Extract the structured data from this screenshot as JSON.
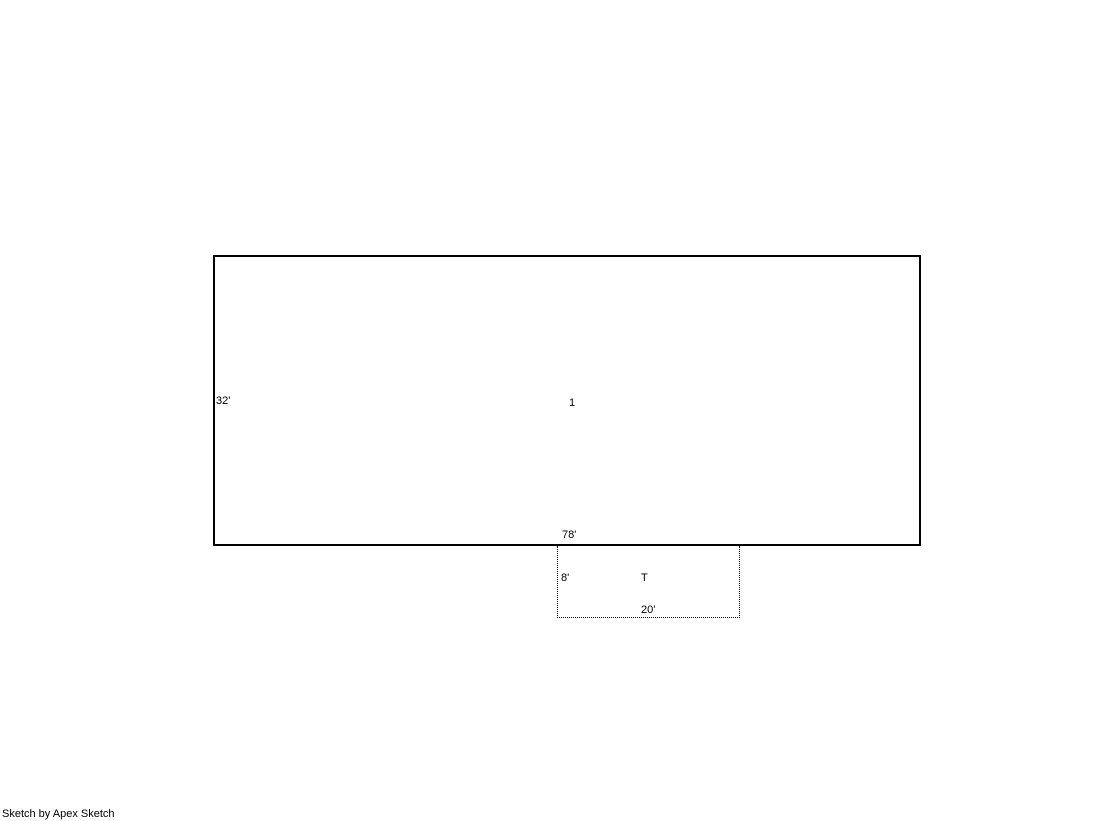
{
  "sketch": {
    "background_color": "#ffffff",
    "line_color": "#000000",
    "area1": {
      "label": "1",
      "outline_style": "solid",
      "left_dim": "32'",
      "bottom_dim": "78'"
    },
    "areaT": {
      "label": "T",
      "outline_style": "dotted",
      "left_dim": "8'",
      "bottom_dim": "20'"
    }
  },
  "footer": {
    "credit": "Sketch by Apex Sketch"
  }
}
